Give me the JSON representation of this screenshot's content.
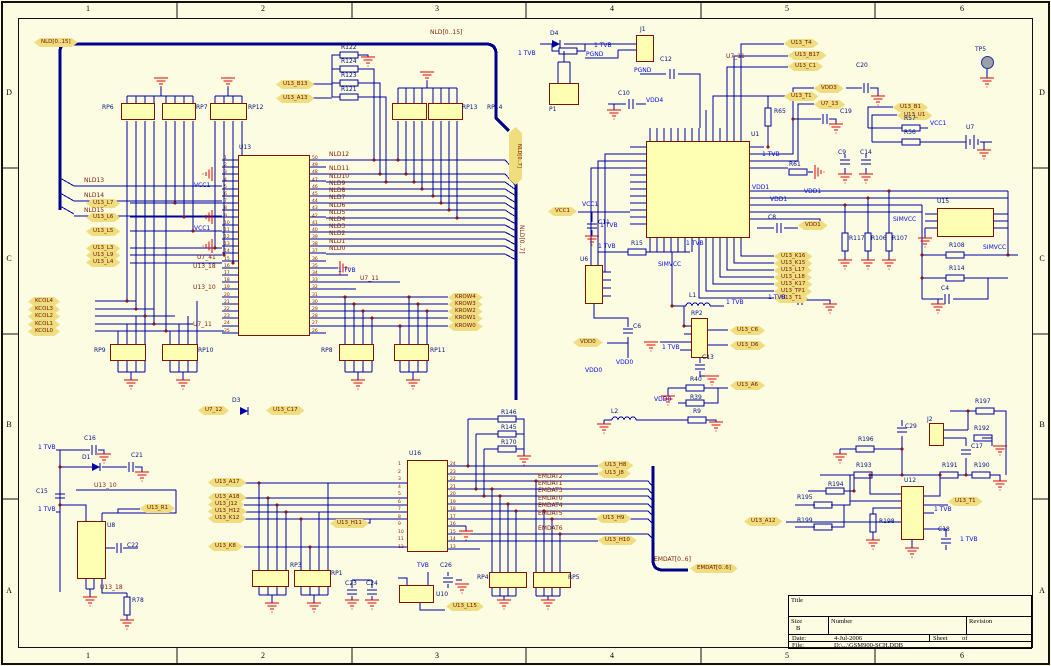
{
  "border": {
    "top": [
      {
        "t": "1",
        "x": 73,
        "y": 4
      },
      {
        "t": "2",
        "x": 248,
        "y": 4
      },
      {
        "t": "3",
        "x": 422,
        "y": 4
      },
      {
        "t": "4",
        "x": 597,
        "y": 4
      },
      {
        "t": "5",
        "x": 772,
        "y": 4
      },
      {
        "t": "6",
        "x": 947,
        "y": 4
      }
    ],
    "bottom": [
      {
        "t": "1",
        "x": 73,
        "y": 651
      },
      {
        "t": "2",
        "x": 248,
        "y": 651
      },
      {
        "t": "3",
        "x": 422,
        "y": 651
      },
      {
        "t": "4",
        "x": 597,
        "y": 651
      },
      {
        "t": "5",
        "x": 772,
        "y": 651
      },
      {
        "t": "6",
        "x": 947,
        "y": 651
      }
    ],
    "left": [
      {
        "t": "D",
        "x": 2,
        "y": 88
      },
      {
        "t": "C",
        "x": 2,
        "y": 254
      },
      {
        "t": "B",
        "x": 2,
        "y": 420
      },
      {
        "t": "A",
        "x": 2,
        "y": 586
      }
    ],
    "right": [
      {
        "t": "D",
        "x": 1035,
        "y": 88
      },
      {
        "t": "C",
        "x": 1035,
        "y": 254
      },
      {
        "t": "B",
        "x": 1035,
        "y": 420
      },
      {
        "t": "A",
        "x": 1035,
        "y": 586
      }
    ]
  },
  "title_block": {
    "title_label": "Title",
    "size_label": "Size",
    "size_value": "B",
    "number_label": "Number",
    "revision_label": "Revision",
    "date_label": "Date:",
    "date_value": "4-Jul-2006",
    "file_label": "File:",
    "file_value": "D:\\...\\GSM900-SCH.DDB",
    "sheet_label": "Sheet",
    "of_label": "of"
  },
  "ports": {
    "nld_vertical": "NLD[0..7]",
    "nld_vertical_net": "NLD[0..7]"
  },
  "labels": {
    "hex": [
      {
        "t": "NLD[0..15]",
        "x": 34,
        "y": 38
      },
      {
        "t": "U13_B13",
        "x": 276,
        "y": 80
      },
      {
        "t": "U13_A13",
        "x": 276,
        "y": 94
      },
      {
        "t": "U13_L7",
        "x": 86,
        "y": 199
      },
      {
        "t": "U13_L6",
        "x": 86,
        "y": 213
      },
      {
        "t": "U13_L5",
        "x": 86,
        "y": 227
      },
      {
        "t": "U13_L3",
        "x": 86,
        "y": 244
      },
      {
        "t": "U13_L9",
        "x": 86,
        "y": 251
      },
      {
        "t": "U13_L4",
        "x": 86,
        "y": 258
      },
      {
        "t": "KCOL4",
        "x": 28,
        "y": 297
      },
      {
        "t": "KCOL3",
        "x": 28,
        "y": 305
      },
      {
        "t": "KCOL2",
        "x": 28,
        "y": 312
      },
      {
        "t": "KCOL1",
        "x": 28,
        "y": 320
      },
      {
        "t": "KCOL0",
        "x": 28,
        "y": 327
      },
      {
        "t": "KROW4",
        "x": 448,
        "y": 293
      },
      {
        "t": "KROW3",
        "x": 448,
        "y": 300
      },
      {
        "t": "KROW2",
        "x": 448,
        "y": 307
      },
      {
        "t": "KROW1",
        "x": 448,
        "y": 314
      },
      {
        "t": "KROW0",
        "x": 448,
        "y": 322
      },
      {
        "t": "U7_12",
        "x": 198,
        "y": 406
      },
      {
        "t": "U13_C17",
        "x": 266,
        "y": 406
      },
      {
        "t": "U13_T4",
        "x": 784,
        "y": 39
      },
      {
        "t": "U13_B17",
        "x": 788,
        "y": 51
      },
      {
        "t": "U13_C1",
        "x": 788,
        "y": 62
      },
      {
        "t": "U13_T1",
        "x": 784,
        "y": 92
      },
      {
        "t": "VDD3",
        "x": 814,
        "y": 84
      },
      {
        "t": "U7_13",
        "x": 814,
        "y": 100
      },
      {
        "t": "U13_B1",
        "x": 893,
        "y": 103
      },
      {
        "t": "U13_U1",
        "x": 897,
        "y": 111
      },
      {
        "t": "VCC1",
        "x": 548,
        "y": 207
      },
      {
        "t": "VDD1",
        "x": 798,
        "y": 221
      },
      {
        "t": "VDD0",
        "x": 573,
        "y": 338
      },
      {
        "t": "U13_C6",
        "x": 730,
        "y": 326
      },
      {
        "t": "U13_D6",
        "x": 730,
        "y": 341
      },
      {
        "t": "U13_A6",
        "x": 730,
        "y": 381
      },
      {
        "t": "U13_K16",
        "x": 774,
        "y": 252
      },
      {
        "t": "U13_K15",
        "x": 774,
        "y": 259
      },
      {
        "t": "U13_L17",
        "x": 774,
        "y": 266
      },
      {
        "t": "U13_L18",
        "x": 774,
        "y": 273
      },
      {
        "t": "U13_K17",
        "x": 774,
        "y": 280
      },
      {
        "t": "U13_TP1",
        "x": 774,
        "y": 287
      },
      {
        "t": "U13_T1",
        "x": 774,
        "y": 294
      },
      {
        "t": "U13_R1",
        "x": 140,
        "y": 504
      },
      {
        "t": "U13_A17",
        "x": 208,
        "y": 478
      },
      {
        "t": "U13_A18",
        "x": 208,
        "y": 493
      },
      {
        "t": "U13_J12",
        "x": 208,
        "y": 500
      },
      {
        "t": "U13_H12",
        "x": 208,
        "y": 507
      },
      {
        "t": "U13_K12",
        "x": 208,
        "y": 514
      },
      {
        "t": "U13_K8",
        "x": 208,
        "y": 542
      },
      {
        "t": "U13_H11",
        "x": 330,
        "y": 519
      },
      {
        "t": "U13_H8",
        "x": 598,
        "y": 461
      },
      {
        "t": "U13_J8",
        "x": 598,
        "y": 469
      },
      {
        "t": "U13_H9",
        "x": 596,
        "y": 514
      },
      {
        "t": "U13_H10",
        "x": 598,
        "y": 536
      },
      {
        "t": "U13_L15",
        "x": 446,
        "y": 602
      },
      {
        "t": "EMDAT[0..6]",
        "x": 690,
        "y": 564
      },
      {
        "t": "U13_A12",
        "x": 744,
        "y": 517
      },
      {
        "t": "U13_T1",
        "x": 948,
        "y": 497
      }
    ],
    "net": [
      {
        "t": "NLD[0..15]",
        "x": 430,
        "y": 30
      },
      {
        "t": "NLD13",
        "x": 84,
        "y": 178
      },
      {
        "t": "NLD14",
        "x": 84,
        "y": 193
      },
      {
        "t": "NLD15",
        "x": 84,
        "y": 208
      },
      {
        "t": "NLD12",
        "x": 329,
        "y": 152
      },
      {
        "t": "NLD11",
        "x": 329,
        "y": 166
      },
      {
        "t": "NLD10",
        "x": 329,
        "y": 174
      },
      {
        "t": "NLD9",
        "x": 329,
        "y": 181
      },
      {
        "t": "NLD8",
        "x": 329,
        "y": 188
      },
      {
        "t": "NLD7",
        "x": 329,
        "y": 195
      },
      {
        "t": "NLD6",
        "x": 329,
        "y": 203
      },
      {
        "t": "NLD5",
        "x": 329,
        "y": 210
      },
      {
        "t": "NLD4",
        "x": 329,
        "y": 217
      },
      {
        "t": "NLD3",
        "x": 329,
        "y": 224
      },
      {
        "t": "NLD2",
        "x": 329,
        "y": 231
      },
      {
        "t": "NLD1",
        "x": 329,
        "y": 239
      },
      {
        "t": "NLD0",
        "x": 329,
        "y": 246
      },
      {
        "t": "U7_41",
        "x": 197,
        "y": 255
      },
      {
        "t": "U13_18",
        "x": 193,
        "y": 264
      },
      {
        "t": "U13_10",
        "x": 193,
        "y": 285
      },
      {
        "t": "U7_11",
        "x": 193,
        "y": 322
      },
      {
        "t": "U7_11",
        "x": 360,
        "y": 276
      },
      {
        "t": "U7_11",
        "x": 726,
        "y": 54
      },
      {
        "t": "EMDAT2",
        "x": 538,
        "y": 474
      },
      {
        "t": "EMDAT1",
        "x": 538,
        "y": 481
      },
      {
        "t": "EMDAT3",
        "x": 538,
        "y": 488
      },
      {
        "t": "EMDAT0",
        "x": 538,
        "y": 496
      },
      {
        "t": "EMDAT4",
        "x": 538,
        "y": 503
      },
      {
        "t": "EMDAT5",
        "x": 538,
        "y": 511
      },
      {
        "t": "EMDAT6",
        "x": 538,
        "y": 526
      },
      {
        "t": "EMDAT[0..6]",
        "x": 654,
        "y": 557
      },
      {
        "t": "U13_10",
        "x": 94,
        "y": 483
      },
      {
        "t": "U13_18",
        "x": 100,
        "y": 585
      }
    ],
    "ref": [
      {
        "t": "RP6",
        "x": 102,
        "y": 105
      },
      {
        "t": "RP7",
        "x": 196,
        "y": 105
      },
      {
        "t": "RP12",
        "x": 248,
        "y": 105
      },
      {
        "t": "R122",
        "x": 341,
        "y": 45
      },
      {
        "t": "R124",
        "x": 341,
        "y": 59
      },
      {
        "t": "R123",
        "x": 341,
        "y": 73
      },
      {
        "t": "R121",
        "x": 341,
        "y": 87
      },
      {
        "t": "RP13",
        "x": 462,
        "y": 105
      },
      {
        "t": "RP14",
        "x": 487,
        "y": 105
      },
      {
        "t": "U13",
        "x": 239,
        "y": 145
      },
      {
        "t": "RP9",
        "x": 94,
        "y": 348
      },
      {
        "t": "RP10",
        "x": 198,
        "y": 348
      },
      {
        "t": "RP8",
        "x": 321,
        "y": 348
      },
      {
        "t": "RP11",
        "x": 430,
        "y": 348
      },
      {
        "t": "D3",
        "x": 232,
        "y": 398
      },
      {
        "t": "D4",
        "x": 550,
        "y": 31
      },
      {
        "t": "J1",
        "x": 640,
        "y": 27
      },
      {
        "t": "P1",
        "x": 549,
        "y": 107
      },
      {
        "t": "C12",
        "x": 660,
        "y": 57
      },
      {
        "t": "C10",
        "x": 618,
        "y": 91
      },
      {
        "t": "U1",
        "x": 751,
        "y": 132
      },
      {
        "t": "R65",
        "x": 774,
        "y": 109
      },
      {
        "t": "C20",
        "x": 856,
        "y": 63
      },
      {
        "t": "C19",
        "x": 840,
        "y": 109
      },
      {
        "t": "TP5",
        "x": 975,
        "y": 47
      },
      {
        "t": "U7",
        "x": 966,
        "y": 125
      },
      {
        "t": "R57",
        "x": 904,
        "y": 116
      },
      {
        "t": "R56",
        "x": 904,
        "y": 130
      },
      {
        "t": "C9",
        "x": 838,
        "y": 150
      },
      {
        "t": "C14",
        "x": 860,
        "y": 150
      },
      {
        "t": "R61",
        "x": 789,
        "y": 162
      },
      {
        "t": "C8",
        "x": 768,
        "y": 215
      },
      {
        "t": "R117",
        "x": 849,
        "y": 236
      },
      {
        "t": "R106",
        "x": 871,
        "y": 236
      },
      {
        "t": "R107",
        "x": 892,
        "y": 236
      },
      {
        "t": "U15",
        "x": 937,
        "y": 199
      },
      {
        "t": "R108",
        "x": 949,
        "y": 243
      },
      {
        "t": "R114",
        "x": 949,
        "y": 266
      },
      {
        "t": "C4",
        "x": 941,
        "y": 286
      },
      {
        "t": "U6",
        "x": 580,
        "y": 257
      },
      {
        "t": "R15",
        "x": 631,
        "y": 241
      },
      {
        "t": "C11",
        "x": 598,
        "y": 220
      },
      {
        "t": "C6",
        "x": 633,
        "y": 324
      },
      {
        "t": "L1",
        "x": 689,
        "y": 293
      },
      {
        "t": "RP2",
        "x": 691,
        "y": 311
      },
      {
        "t": "C13",
        "x": 702,
        "y": 355
      },
      {
        "t": "R40",
        "x": 690,
        "y": 377
      },
      {
        "t": "R39",
        "x": 690,
        "y": 395
      },
      {
        "t": "R9",
        "x": 693,
        "y": 409
      },
      {
        "t": "L2",
        "x": 611,
        "y": 409
      },
      {
        "t": "C16",
        "x": 84,
        "y": 436
      },
      {
        "t": "D1",
        "x": 82,
        "y": 455
      },
      {
        "t": "C21",
        "x": 131,
        "y": 453
      },
      {
        "t": "C15",
        "x": 36,
        "y": 489
      },
      {
        "t": "U8",
        "x": 107,
        "y": 523
      },
      {
        "t": "C22",
        "x": 127,
        "y": 543
      },
      {
        "t": "R78",
        "x": 132,
        "y": 598
      },
      {
        "t": "U16",
        "x": 409,
        "y": 451
      },
      {
        "t": "R146",
        "x": 501,
        "y": 410
      },
      {
        "t": "R145",
        "x": 501,
        "y": 425
      },
      {
        "t": "R170",
        "x": 501,
        "y": 440
      },
      {
        "t": "RP3",
        "x": 290,
        "y": 563
      },
      {
        "t": "RP1",
        "x": 331,
        "y": 571
      },
      {
        "t": "C23",
        "x": 345,
        "y": 581
      },
      {
        "t": "C24",
        "x": 366,
        "y": 581
      },
      {
        "t": "U10",
        "x": 436,
        "y": 592
      },
      {
        "t": "C26",
        "x": 440,
        "y": 563
      },
      {
        "t": "RP4",
        "x": 477,
        "y": 575
      },
      {
        "t": "RP5",
        "x": 568,
        "y": 575
      },
      {
        "t": "R197",
        "x": 975,
        "y": 399
      },
      {
        "t": "J2",
        "x": 927,
        "y": 417
      },
      {
        "t": "R192",
        "x": 974,
        "y": 426
      },
      {
        "t": "C29",
        "x": 905,
        "y": 424
      },
      {
        "t": "C17",
        "x": 971,
        "y": 444
      },
      {
        "t": "R196",
        "x": 858,
        "y": 437
      },
      {
        "t": "R193",
        "x": 856,
        "y": 463
      },
      {
        "t": "R191",
        "x": 942,
        "y": 463
      },
      {
        "t": "R190",
        "x": 974,
        "y": 463
      },
      {
        "t": "R194",
        "x": 828,
        "y": 482
      },
      {
        "t": "R195",
        "x": 797,
        "y": 495
      },
      {
        "t": "R199",
        "x": 797,
        "y": 518
      },
      {
        "t": "U12",
        "x": 904,
        "y": 478
      },
      {
        "t": "R198",
        "x": 879,
        "y": 519
      },
      {
        "t": "C18",
        "x": 938,
        "y": 527
      }
    ],
    "blu": [
      {
        "t": "1 TVB",
        "x": 38,
        "y": 445
      },
      {
        "t": "1 TVB",
        "x": 38,
        "y": 507
      },
      {
        "t": "1 TVB",
        "x": 518,
        "y": 51
      },
      {
        "t": "1 TVB",
        "x": 594,
        "y": 43
      },
      {
        "t": "PGND",
        "x": 586,
        "y": 52
      },
      {
        "t": "PGND",
        "x": 634,
        "y": 68
      },
      {
        "t": "VDD4",
        "x": 646,
        "y": 98
      },
      {
        "t": "VCC1",
        "x": 194,
        "y": 183
      },
      {
        "t": "VCC1",
        "x": 194,
        "y": 226
      },
      {
        "t": "VCC1",
        "x": 582,
        "y": 202
      },
      {
        "t": "VCC1",
        "x": 930,
        "y": 121
      },
      {
        "t": "1 TVB",
        "x": 598,
        "y": 244
      },
      {
        "t": "1 TVB",
        "x": 338,
        "y": 268
      },
      {
        "t": "1 TVB",
        "x": 762,
        "y": 152
      },
      {
        "t": "1 TVB",
        "x": 600,
        "y": 223
      },
      {
        "t": "1 TVB",
        "x": 726,
        "y": 300
      },
      {
        "t": "1 TVB",
        "x": 662,
        "y": 345
      },
      {
        "t": "1 TVB",
        "x": 686,
        "y": 241
      },
      {
        "t": "SIMVCC",
        "x": 658,
        "y": 262
      },
      {
        "t": "1 TVB",
        "x": 768,
        "y": 295
      },
      {
        "t": "VDD1",
        "x": 752,
        "y": 185
      },
      {
        "t": "VDD1",
        "x": 804,
        "y": 189
      },
      {
        "t": "VDD0",
        "x": 616,
        "y": 360
      },
      {
        "t": "VDD0",
        "x": 654,
        "y": 397
      },
      {
        "t": "SIMVCC",
        "x": 893,
        "y": 217
      },
      {
        "t": "SIMVCC",
        "x": 983,
        "y": 245
      },
      {
        "t": "TVB",
        "x": 417,
        "y": 563
      },
      {
        "t": "1 TVB",
        "x": 934,
        "y": 507
      },
      {
        "t": "1 TVB",
        "x": 960,
        "y": 537
      },
      {
        "t": "VDD1",
        "x": 770,
        "y": 197
      },
      {
        "t": "VDD0",
        "x": 585,
        "y": 368
      }
    ]
  },
  "u13": {
    "left_pins": [
      "1",
      "2",
      "3",
      "4",
      "5",
      "6",
      "7",
      "8",
      "9",
      "10",
      "11",
      "12",
      "13",
      "14",
      "15",
      "16",
      "17",
      "18",
      "19",
      "20",
      "21",
      "22",
      "23",
      "24",
      "25"
    ],
    "right_pins": [
      "50",
      "49",
      "48",
      "47",
      "46",
      "45",
      "44",
      "43",
      "42",
      "41",
      "40",
      "39",
      "38",
      "37",
      "36",
      "35",
      "34",
      "33",
      "32",
      "31",
      "30",
      "29",
      "28",
      "27",
      "26"
    ]
  },
  "u16": {
    "left_pins": [
      "1",
      "2",
      "3",
      "4",
      "5",
      "6",
      "7",
      "8",
      "9",
      "10",
      "11",
      "12"
    ],
    "right_pins": [
      "24",
      "23",
      "22",
      "21",
      "20",
      "19",
      "18",
      "17",
      "16",
      "15",
      "14",
      "13"
    ]
  }
}
